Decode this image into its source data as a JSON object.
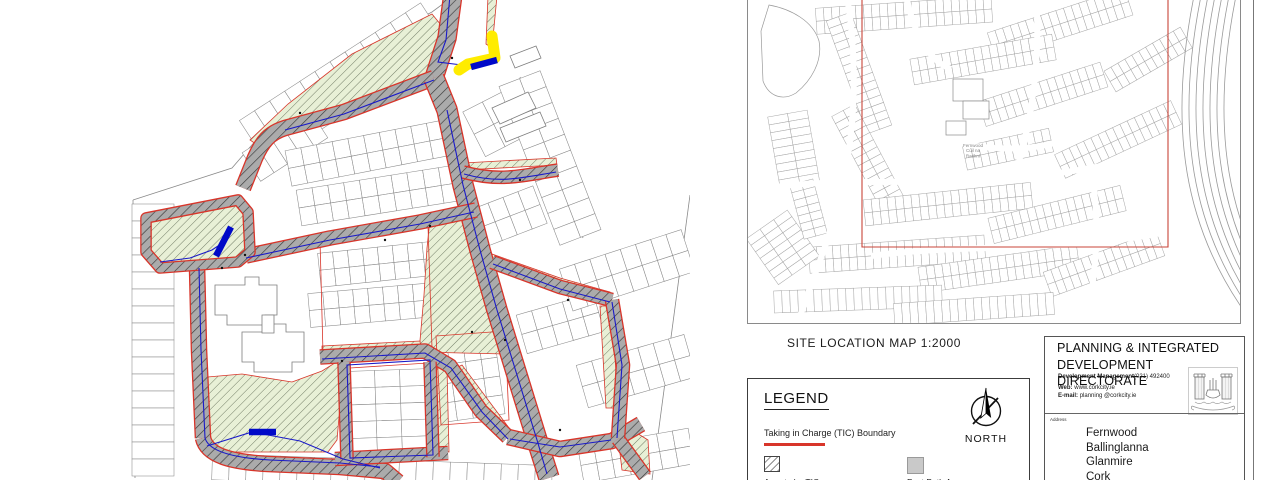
{
  "site_location_map": {
    "label": "SITE LOCATION MAP 1:2000",
    "inner_label_lines": [
      "Fernwood",
      "Cúil na",
      "Raithní"
    ]
  },
  "legend": {
    "title": "LEGEND",
    "items": [
      {
        "swatch": "red-line",
        "label": "Taking in Charge (TIC) Boundary"
      },
      {
        "swatch": "hatch",
        "label": "Area to be TIC"
      },
      {
        "swatch": "gray",
        "label": "Foot Path Area"
      }
    ],
    "north_label": "NORTH"
  },
  "title_block": {
    "org_line1": "PLANNING & INTEGRATED",
    "org_line2": "DEVELOPMENT DIRECTORATE",
    "dept": "Development Management",
    "phone": "(021) 492400",
    "web_label": "Web:",
    "web": "www.corkcity.ie",
    "email_label": "E-mail:",
    "email": "planning @corkcity.ie",
    "address_label": "Address",
    "address_lines": [
      "Fernwood",
      "Ballinglanna",
      "Glanmire",
      "Cork"
    ]
  },
  "colors": {
    "tic_boundary_red": "#d8352a",
    "road_gray": "#ababab",
    "open_space_green": "#e8f0d6",
    "highlight_yellow": "#ffec00",
    "service_blue": "#1a1ac8",
    "footpath_gray": "#c9c9c9"
  }
}
